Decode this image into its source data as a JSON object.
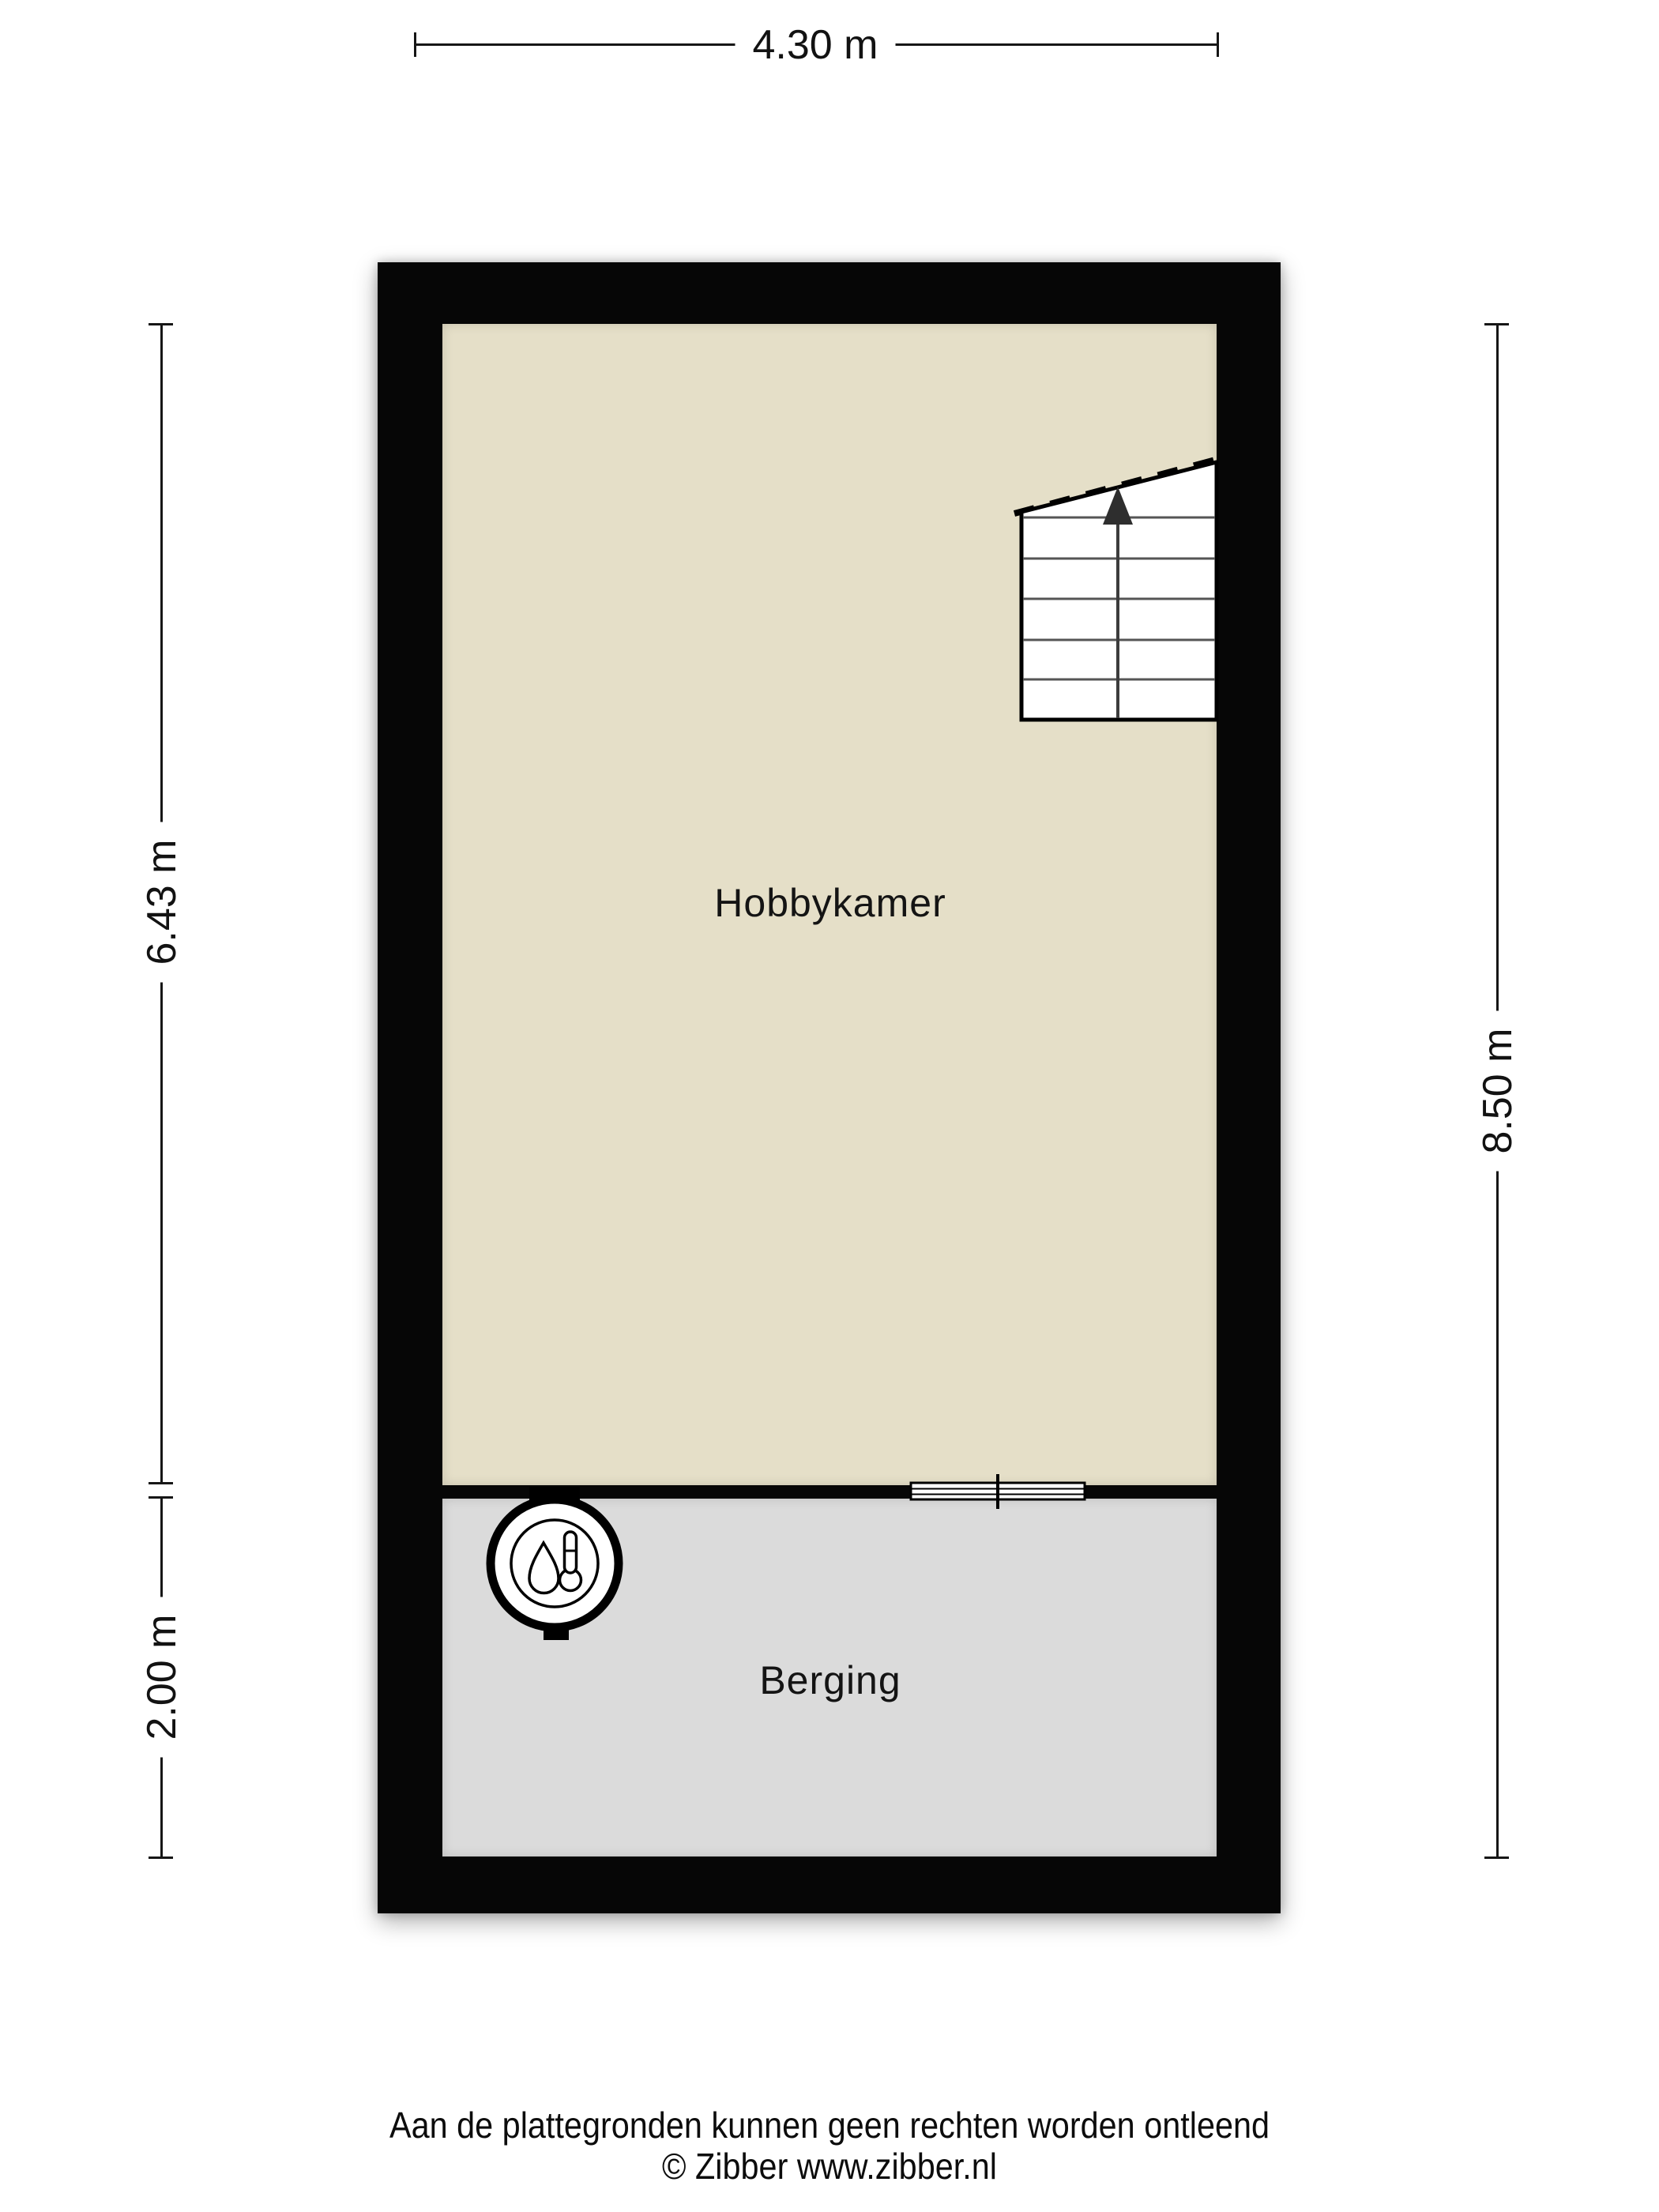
{
  "colors": {
    "background": "#ffffff",
    "wall": "#060606",
    "hobbykamer_fill": "#e5dfc8",
    "berging_fill": "#dbdbdb"
  },
  "dimensions": {
    "top": "4.30 m",
    "left_upper": "6.43 m",
    "left_lower": "2.00 m",
    "right": "8.50 m"
  },
  "rooms": {
    "hobbykamer": {
      "label": "Hobbykamer"
    },
    "berging": {
      "label": "Berging"
    }
  },
  "icons": {
    "heater": "heater-icon",
    "staircase": "staircase-icon",
    "stairs_arrow": "arrow-up-icon",
    "door_marker": "window-door-marker-icon"
  },
  "footer": {
    "disclaimer": "Aan de plattegronden kunnen geen rechten worden ontleend",
    "copyright": "© Zibber www.zibber.nl"
  }
}
